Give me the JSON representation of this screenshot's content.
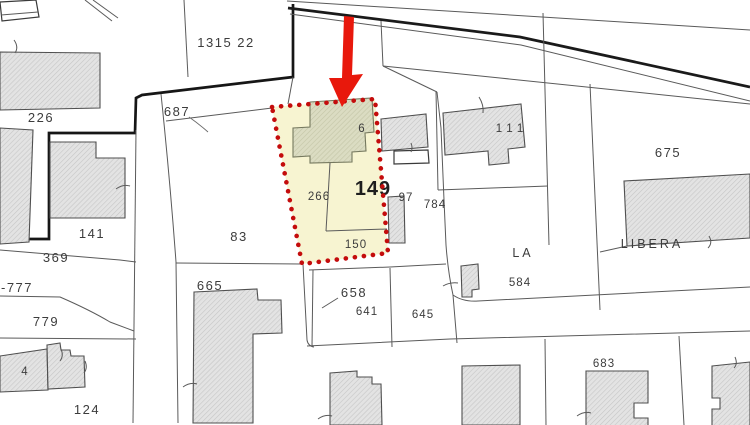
{
  "map": {
    "description": "cadastral parcel map with highlighted parcel and red arrow marker",
    "labels": {
      "p226": "226",
      "p1315_22": "1315 22",
      "p687": "687",
      "p141": "141",
      "p369": "369",
      "p777": "-777",
      "p779": "779",
      "p4": "4",
      "p124": "124",
      "p83": "83",
      "p665": "665",
      "p658": "658",
      "p641": "641",
      "p645": "645",
      "p266": "266",
      "p149": "149",
      "p97": "97",
      "p784": "784",
      "p150": "150",
      "p6": "6",
      "p111": "111",
      "p675": "675",
      "p584": "584",
      "p683": "683",
      "street_la": "LA",
      "street_libera": "LIBERA"
    },
    "highlight": {
      "parcel_labels": [
        "266",
        "149",
        "150"
      ],
      "building_label": "6",
      "border_color": "#c40c0c",
      "fill_color": "#f7f4d1",
      "building_fill": "#dbdcc2"
    },
    "arrow_color": "#e8180c",
    "colors": {
      "building_fill": "#e3e3e3",
      "building_hatch": "#c6c6c6",
      "boundary_line": "#5a5a5a",
      "thick_boundary": "#161616",
      "label_text": "#3c3c3c"
    }
  }
}
